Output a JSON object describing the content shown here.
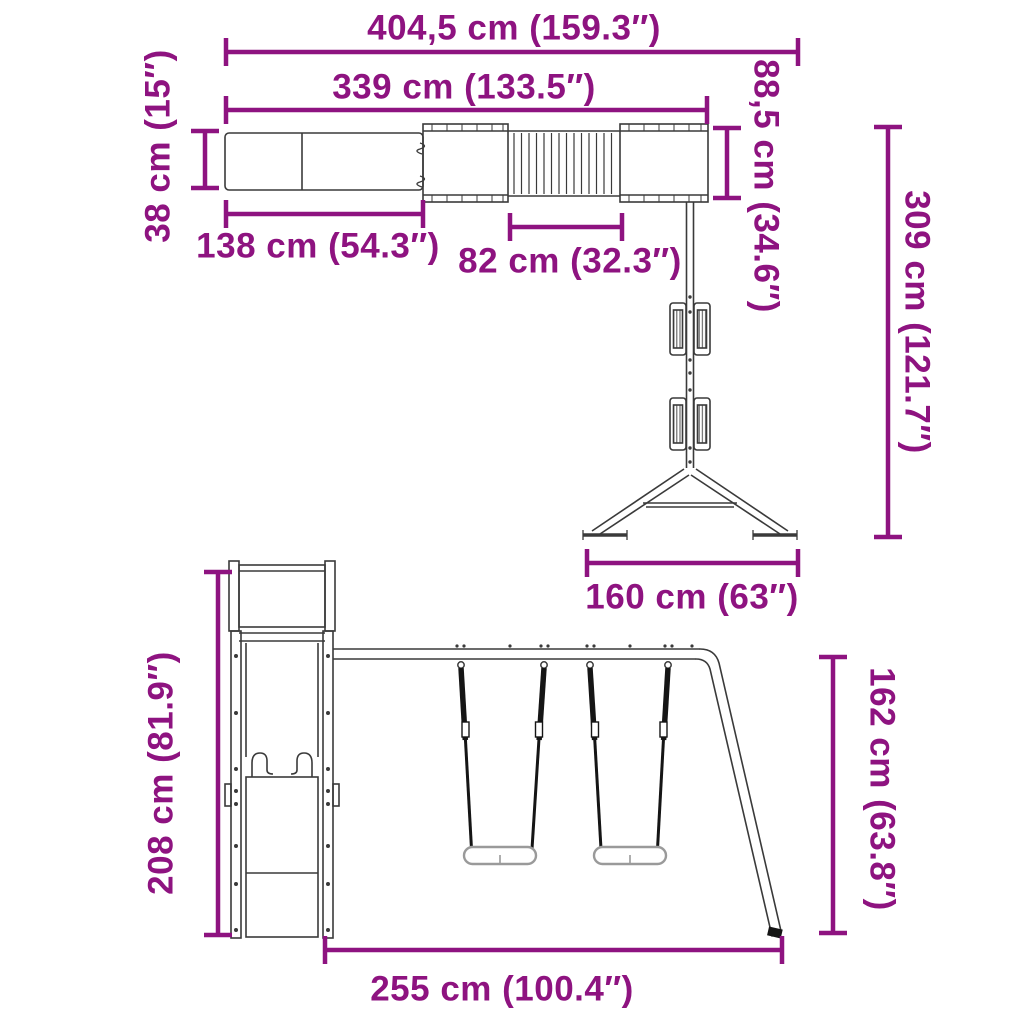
{
  "diagram": {
    "measurements": {
      "overall_width": "404,5 cm (159.3″)",
      "upper_frame_width": "339 cm (133.5″)",
      "slide_width": "38 cm (15″)",
      "slide_length": "138 cm (54.3″)",
      "bridge_length": "82 cm (32.3″)",
      "platform_depth": "88,5 cm (34.6″)",
      "swing_frame_depth": "309 cm (121.7″)",
      "swing_base_width": "160 cm (63″)",
      "tower_height": "208 cm (81.9″)",
      "swing_beam_height": "162 cm (63.8″)",
      "swing_section_length": "255 cm (100.4″)"
    }
  },
  "colors": {
    "dimension": "#8E1380",
    "structure": "#3A3A3A",
    "rope": "#151515",
    "seat": "#9A9A9A",
    "background": "#FFFFFF"
  }
}
